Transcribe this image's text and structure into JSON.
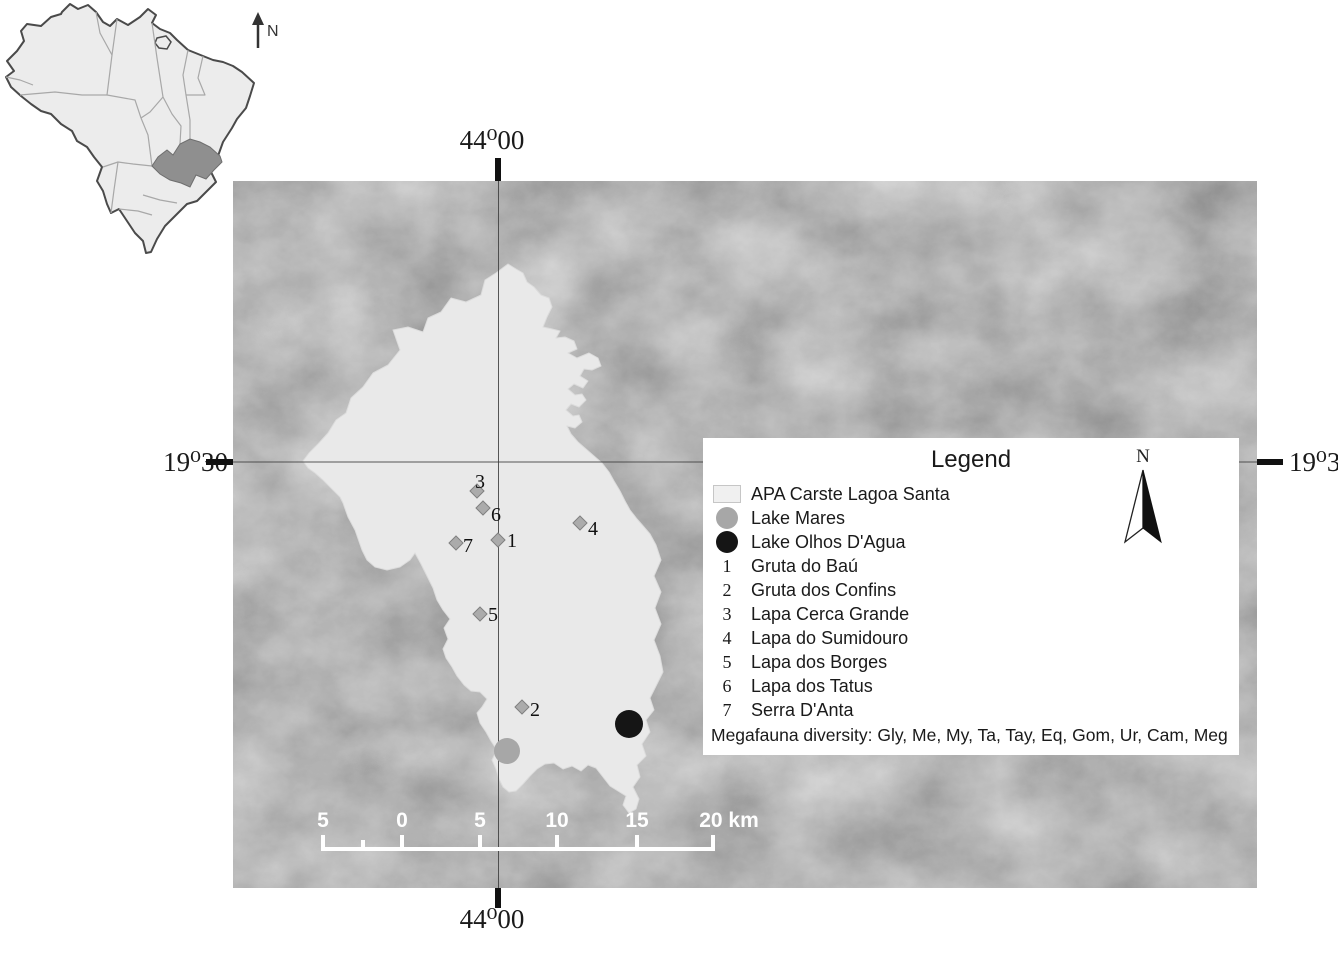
{
  "inset": {
    "north_label": "N"
  },
  "map": {
    "coordinates": {
      "top": "44⁰00",
      "bottom": "44⁰00",
      "left": "19⁰30",
      "right": "19⁰30"
    },
    "scale_bar": {
      "labels": [
        "5",
        "0",
        "5",
        "10",
        "15",
        "20 km"
      ],
      "unit": "km"
    },
    "area_label": "APA Carste Lagoa Santa",
    "sites": [
      {
        "id": "1",
        "name": "Gruta do Baú",
        "x": 498,
        "y": 540
      },
      {
        "id": "2",
        "name": "Gruta dos Confins",
        "x": 522,
        "y": 707
      },
      {
        "id": "3",
        "name": "Lapa Cerca Grande",
        "x": 477,
        "y": 491
      },
      {
        "id": "4",
        "name": "Lapa do Sumidouro",
        "x": 580,
        "y": 523
      },
      {
        "id": "5",
        "name": "Lapa dos Borges",
        "x": 480,
        "y": 614
      },
      {
        "id": "6",
        "name": "Lapa dos Tatus",
        "x": 483,
        "y": 508
      },
      {
        "id": "7",
        "name": "Serra D'Anta",
        "x": 456,
        "y": 543
      }
    ],
    "lakes": [
      {
        "name": "Lake Mares",
        "x": 507,
        "y": 751,
        "r": 13,
        "color": "#a7a7a7"
      },
      {
        "name": "Lake Olhos D'Agua",
        "x": 629,
        "y": 724,
        "r": 14,
        "color": "#151515"
      }
    ]
  },
  "legend": {
    "title": "Legend",
    "north_label": "N",
    "items": [
      {
        "type": "area",
        "label": "APA Carste Lagoa Santa",
        "color": "#f0f0f0"
      },
      {
        "type": "lake",
        "label": "Lake Mares",
        "color": "#a7a7a7"
      },
      {
        "type": "lake",
        "label": "Lake Olhos D'Agua",
        "color": "#151515"
      },
      {
        "type": "site",
        "key": "1",
        "label": "Gruta do Baú"
      },
      {
        "type": "site",
        "key": "2",
        "label": "Gruta dos Confins"
      },
      {
        "type": "site",
        "key": "3",
        "label": "Lapa Cerca Grande"
      },
      {
        "type": "site",
        "key": "4",
        "label": "Lapa do Sumidouro"
      },
      {
        "type": "site",
        "key": "5",
        "label": "Lapa dos Borges"
      },
      {
        "type": "site",
        "key": "6",
        "label": "Lapa dos Tatus"
      },
      {
        "type": "site",
        "key": "7",
        "label": "Serra D'Anta"
      }
    ],
    "footnote": "Megafauna diversity: Gly, Me, My, Ta, Tay, Eq, Gom, Ur, Cam, Meg"
  }
}
